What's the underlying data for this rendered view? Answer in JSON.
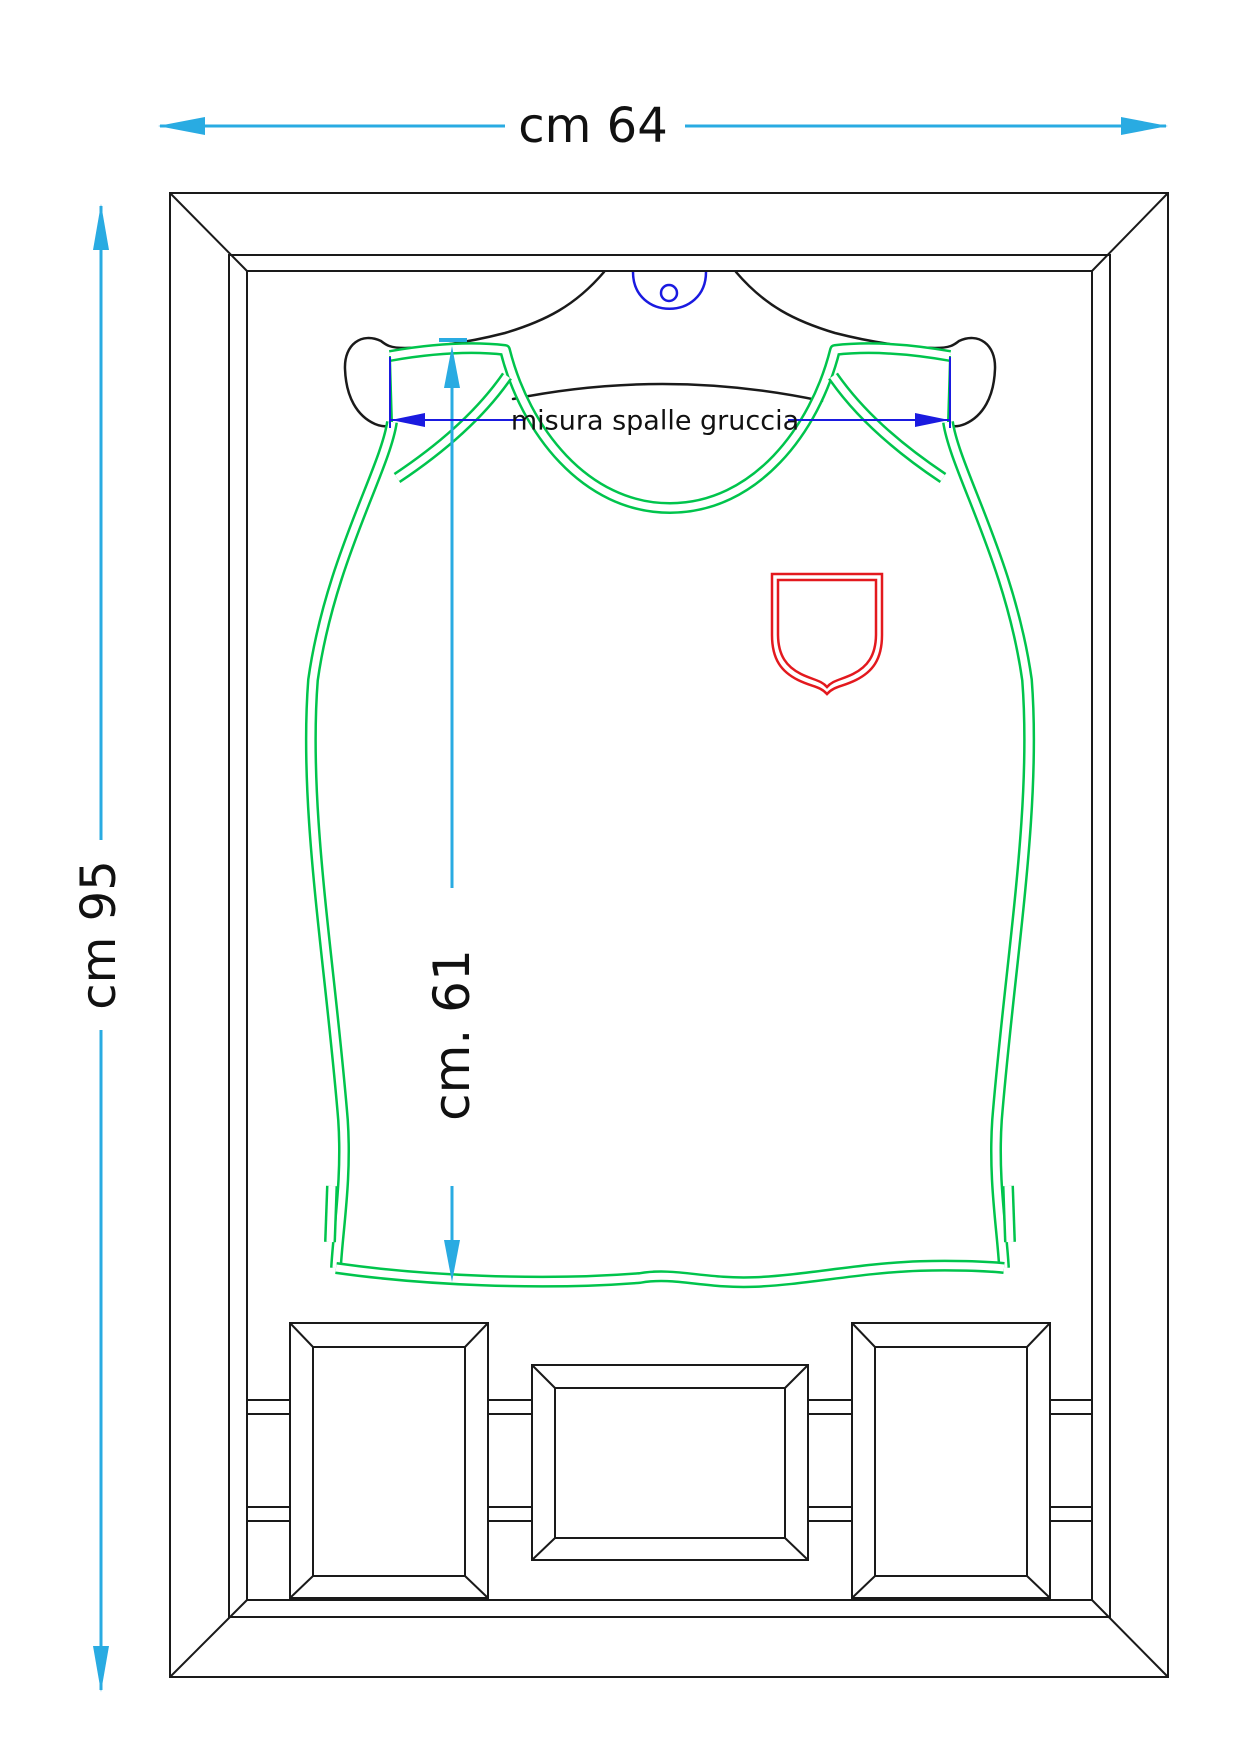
{
  "drawing": {
    "type": "framed jersey display technical drawing",
    "dimensions": {
      "width_label": "cm 64",
      "height_label": "cm 95",
      "jersey_length_label": "cm. 61",
      "shoulder_label": "misura spalle gruccia"
    }
  },
  "colors": {
    "dimension_cyan": "#29ABE2",
    "dimension_blue": "#1A1AE0",
    "jersey_green": "#00C44C",
    "crest_red": "#E3191E",
    "line_black": "#1A1A1A",
    "background": "#FFFFFF"
  }
}
